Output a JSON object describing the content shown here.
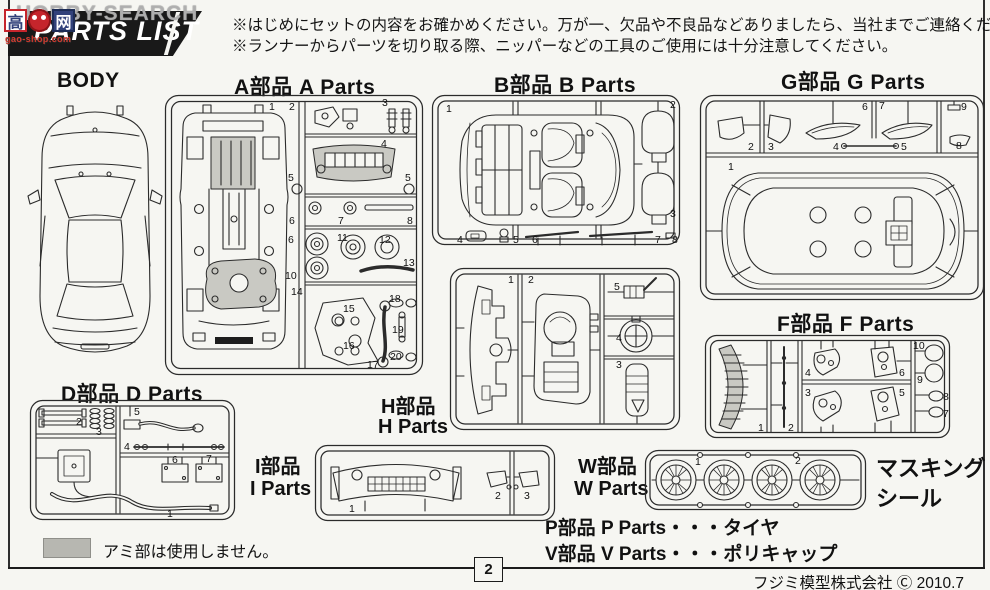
{
  "colors": {
    "page_bg": "#f6f6f2",
    "line": "#2b2b2b",
    "banner_bg": "#191919",
    "banner_text": "#ffffff",
    "shade_gray": "#c9c9c3",
    "watermark_gray": "#bebebe",
    "logo_red": "#c5252c",
    "logo_blue": "#31417a"
  },
  "header": {
    "banner_title": "PARTS LIST",
    "watermark": {
      "text": "HOBBY-SEARCH",
      "logo_char_1": "高",
      "logo_char_2": "网",
      "logo_url": "gao-shop.com"
    },
    "notes": [
      "※はじめにセットの内容をお確かめください。万が一、欠品や不良品などありましたら、当社までご連絡ください。",
      "※ランナーからパーツを切り取る際、ニッパーなどの工具のご使用には十分注意してください。"
    ]
  },
  "sections": {
    "body": {
      "label": "BODY"
    },
    "a": {
      "label": "A部品  A Parts",
      "numbers": [
        "1",
        "2",
        "3",
        "4",
        "5",
        "5",
        "6",
        "7",
        "8",
        "6",
        "11",
        "12",
        "10",
        "13",
        "14",
        "15",
        "16",
        "17",
        "18",
        "19",
        "20"
      ]
    },
    "b": {
      "label": "B部品  B Parts",
      "numbers": [
        "1",
        "2",
        "3",
        "4",
        "5",
        "6",
        "7",
        "8"
      ]
    },
    "g": {
      "label": "G部品  G Parts",
      "numbers": [
        "1",
        "2",
        "3",
        "4",
        "5",
        "6",
        "7",
        "8",
        "9"
      ]
    },
    "h": {
      "label_jp": "H部品",
      "label_en": "H Parts",
      "numbers": [
        "1",
        "2",
        "3",
        "4",
        "5"
      ]
    },
    "d": {
      "label": "D部品  D Parts",
      "numbers": [
        "1",
        "2",
        "3",
        "4",
        "5",
        "6",
        "7"
      ]
    },
    "i": {
      "label_jp": "I部品",
      "label_en": "I Parts",
      "numbers": [
        "1",
        "2",
        "3"
      ]
    },
    "f": {
      "label": "F部品  F Parts",
      "numbers": [
        "1",
        "2",
        "3",
        "4",
        "5",
        "6",
        "7",
        "8",
        "9",
        "10"
      ]
    },
    "w": {
      "label_jp": "W部品",
      "label_en": "W Parts",
      "numbers": [
        "1",
        "2"
      ]
    },
    "masking": {
      "line1": "マスキング",
      "line2": "シール"
    },
    "p_line": "P部品 P Parts・・・タイヤ",
    "v_line": "V部品 V Parts・・・ポリキャップ",
    "ami_note": "アミ部は使用しません。"
  },
  "footer": {
    "page_number": "2",
    "copyright": "フジミ模型株式会社 Ⓒ 2010.7"
  }
}
